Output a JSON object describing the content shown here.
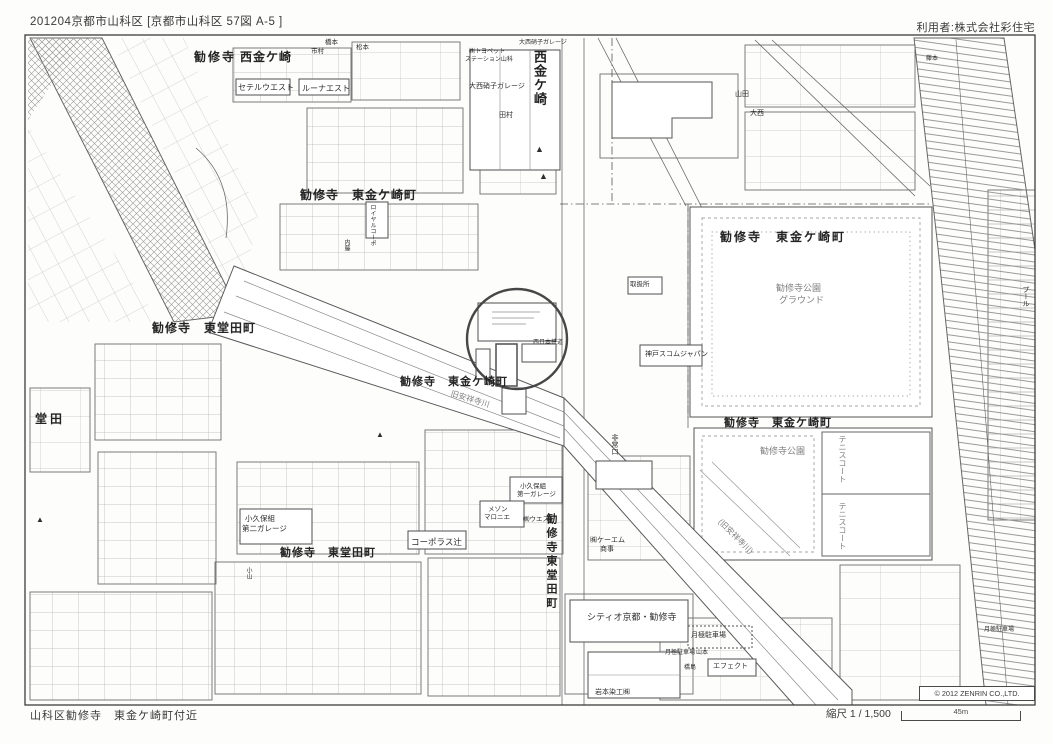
{
  "header": {
    "left": "201204京都市山科区 [京都市山科区 57図 A-5 ]",
    "right": "利用者:株式会社彩住宅"
  },
  "footer": {
    "area_note": "山科区勧修寺　東金ケ崎町付近",
    "scale_label": "縮尺 1 / 1,500",
    "scale_distance": "45m"
  },
  "map": {
    "copyright": "© 2012 ZENRIN CO.,LTD.",
    "colors": {
      "ink": "#2e2e2e",
      "gray_label": "#7e7e7e",
      "highlight_circle": "#474747",
      "frame": "#3c3c3c"
    },
    "labels": [
      {
        "t": "勧修寺",
        "x": 194,
        "y": 51,
        "fs": 12,
        "b": 1,
        "ls": 2
      },
      {
        "t": "西金ケ崎",
        "x": 240,
        "y": 51,
        "fs": 12,
        "b": 1,
        "ls": 1
      },
      {
        "t": "セテルウエスト",
        "x": 238,
        "y": 84,
        "fs": 8
      },
      {
        "t": "ルーナエスト",
        "x": 302,
        "y": 85,
        "fs": 8
      },
      {
        "t": "市村",
        "x": 311,
        "y": 49,
        "fs": 6.5
      },
      {
        "t": "橋本",
        "x": 325,
        "y": 40,
        "fs": 6.5
      },
      {
        "t": "松本",
        "x": 356,
        "y": 45,
        "fs": 6.5
      },
      {
        "t": "西金ケ崎",
        "x": 533,
        "y": 50,
        "fs": 13,
        "v": 1,
        "b": 1,
        "ls": 1
      },
      {
        "t": "勧修寺　東金ケ崎町",
        "x": 300,
        "y": 189,
        "fs": 12,
        "b": 1,
        "ls": 1
      },
      {
        "t": "勧修寺　東堂田町",
        "x": 152,
        "y": 322,
        "fs": 12,
        "b": 1,
        "ls": 1
      },
      {
        "t": "勧修寺　東金ケ崎町",
        "x": 400,
        "y": 377,
        "fs": 11,
        "b": 1,
        "ls": 1
      },
      {
        "t": "旧安祥寺川",
        "x": 452,
        "y": 390,
        "fs": 8,
        "r": 17,
        "c": "g"
      },
      {
        "t": "(旧安祥寺川)",
        "x": 722,
        "y": 518,
        "fs": 8,
        "r": 45,
        "c": "g"
      },
      {
        "t": "勧修寺　東金ケ崎町",
        "x": 720,
        "y": 231,
        "fs": 12,
        "b": 1,
        "ls": 2
      },
      {
        "t": "勧修寺公園",
        "x": 776,
        "y": 284,
        "fs": 9,
        "c": "g"
      },
      {
        "t": "グラウンド",
        "x": 779,
        "y": 296,
        "fs": 9,
        "c": "g"
      },
      {
        "t": "勧修寺　東金ケ崎町",
        "x": 724,
        "y": 418,
        "fs": 11,
        "b": 1,
        "ls": 1
      },
      {
        "t": "勧修寺公園",
        "x": 760,
        "y": 447,
        "fs": 9,
        "c": "g"
      },
      {
        "t": "テニスコート",
        "x": 838,
        "y": 435,
        "fs": 8,
        "v": 1,
        "c": "g"
      },
      {
        "t": "テニスコート",
        "x": 838,
        "y": 502,
        "fs": 8,
        "v": 1,
        "c": "g"
      },
      {
        "t": "堂田",
        "x": 35,
        "y": 413,
        "fs": 12,
        "b": 1,
        "ls": 3
      },
      {
        "t": "勧修寺　東堂田町",
        "x": 280,
        "y": 548,
        "fs": 11,
        "b": 1,
        "ls": 1
      },
      {
        "t": "勧修寺東堂田町",
        "x": 545,
        "y": 513,
        "fs": 11,
        "v": 1,
        "b": 1,
        "ls": 3
      },
      {
        "t": "小久保組",
        "x": 245,
        "y": 515,
        "fs": 7.5
      },
      {
        "t": "第二ガレージ",
        "x": 242,
        "y": 525,
        "fs": 7.5
      },
      {
        "t": "コーポラス辻",
        "x": 411,
        "y": 538,
        "fs": 8.5
      },
      {
        "t": "小久保組",
        "x": 520,
        "y": 484,
        "fs": 6.5
      },
      {
        "t": "第一ガレージ",
        "x": 517,
        "y": 492,
        "fs": 6.5
      },
      {
        "t": "メゾン",
        "x": 488,
        "y": 507,
        "fs": 6.5
      },
      {
        "t": "マロニエ",
        "x": 484,
        "y": 515,
        "fs": 6.5
      },
      {
        "t": "㈱ウエスト",
        "x": 523,
        "y": 517,
        "fs": 6.5
      },
      {
        "t": "㈱ケーエム",
        "x": 590,
        "y": 537,
        "fs": 7
      },
      {
        "t": "商事",
        "x": 600,
        "y": 546,
        "fs": 7
      },
      {
        "t": "シティオ京都・勧修寺",
        "x": 587,
        "y": 613,
        "fs": 9
      },
      {
        "t": "月極駐車場",
        "x": 691,
        "y": 632,
        "fs": 7
      },
      {
        "t": "月極駐車場",
        "x": 665,
        "y": 650,
        "fs": 6
      },
      {
        "t": "山本",
        "x": 696,
        "y": 650,
        "fs": 6
      },
      {
        "t": "橋島",
        "x": 684,
        "y": 665,
        "fs": 6
      },
      {
        "t": "エフェクト",
        "x": 713,
        "y": 663,
        "fs": 7
      },
      {
        "t": "岩本染工㈱",
        "x": 595,
        "y": 689,
        "fs": 7
      },
      {
        "t": "非常口",
        "x": 611,
        "y": 434,
        "fs": 7,
        "v": 1
      },
      {
        "t": "西日本鉄道",
        "x": 533,
        "y": 340,
        "fs": 6
      },
      {
        "t": "㈱トヨペット",
        "x": 469,
        "y": 49,
        "fs": 6
      },
      {
        "t": "ステーション山科",
        "x": 465,
        "y": 57,
        "fs": 6
      },
      {
        "t": "大西硝子ガレージ",
        "x": 469,
        "y": 83,
        "fs": 7
      },
      {
        "t": "大西硝子ガレージ",
        "x": 519,
        "y": 40,
        "fs": 6
      },
      {
        "t": "田村",
        "x": 499,
        "y": 112,
        "fs": 7
      },
      {
        "t": "山田",
        "x": 735,
        "y": 91,
        "fs": 7
      },
      {
        "t": "大西",
        "x": 750,
        "y": 110,
        "fs": 7
      },
      {
        "t": "ロイヤルコーポ",
        "x": 369,
        "y": 204,
        "fs": 6,
        "v": 1
      },
      {
        "t": "内藤",
        "x": 343,
        "y": 239,
        "fs": 6,
        "v": 1
      },
      {
        "t": "神戸スコムジャパン",
        "x": 645,
        "y": 351,
        "fs": 7
      },
      {
        "t": "取扱所",
        "x": 630,
        "y": 282,
        "fs": 6.5
      },
      {
        "t": "藤本",
        "x": 926,
        "y": 56,
        "fs": 6
      },
      {
        "t": "プール",
        "x": 1022,
        "y": 286,
        "fs": 7,
        "v": 1
      },
      {
        "t": "月極駐車場",
        "x": 984,
        "y": 627,
        "fs": 6
      },
      {
        "t": "小山",
        "x": 245,
        "y": 567,
        "fs": 6,
        "v": 1
      },
      {
        "t": "▲",
        "x": 535,
        "y": 145,
        "fs": 9
      },
      {
        "t": "▲",
        "x": 539,
        "y": 172,
        "fs": 9
      },
      {
        "t": "▲",
        "x": 376,
        "y": 431,
        "fs": 8
      },
      {
        "t": "▲",
        "x": 36,
        "y": 516,
        "fs": 8
      }
    ]
  }
}
